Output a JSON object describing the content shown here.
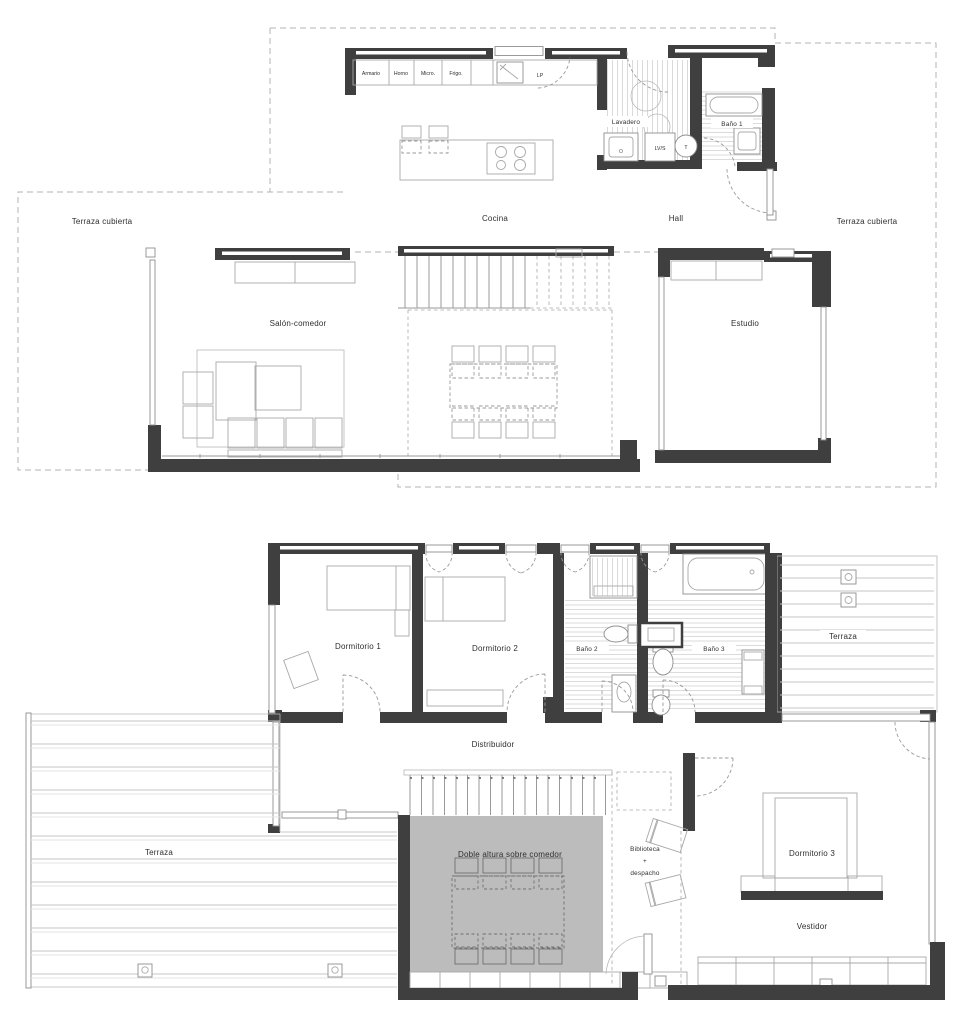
{
  "plan": {
    "colors": {
      "wall": "#3f3f3f",
      "dash": "#b3b3b3",
      "hatch": "#cbcbcb",
      "void_fill": "#bcbcbc",
      "text": "#2e2e2e"
    },
    "floor_ground": {
      "rooms": {
        "cocina": "Cocina",
        "hall": "Hall",
        "lavadero": "Lavadero",
        "bano1": "Baño 1",
        "salon_comedor": "Salón-comedor",
        "estudio": "Estudio",
        "terraza_cubierta_izq": "Terraza cubierta",
        "terraza_cubierta_der": "Terraza cubierta"
      },
      "fixtures": {
        "armario": "Armario",
        "horno": "Horno",
        "micro": "Micro.",
        "frigo": "Frigo.",
        "lp": "LP",
        "lvs": "LV/S",
        "t": "T"
      }
    },
    "floor_first": {
      "rooms": {
        "dormitorio1": "Dormitorio 1",
        "dormitorio2": "Dormitorio 2",
        "bano2": "Baño 2",
        "bano3": "Baño 3",
        "terraza_der": "Terraza",
        "distribuidor": "Distribuidor",
        "doble_altura": "Doble altura sobre comedor",
        "biblioteca_l1": "Biblioteca",
        "biblioteca_l2": "+",
        "biblioteca_l3": "despacho",
        "dormitorio3": "Dormitorio 3",
        "vestidor": "Vestidor",
        "terraza_izq": "Terraza"
      }
    }
  }
}
